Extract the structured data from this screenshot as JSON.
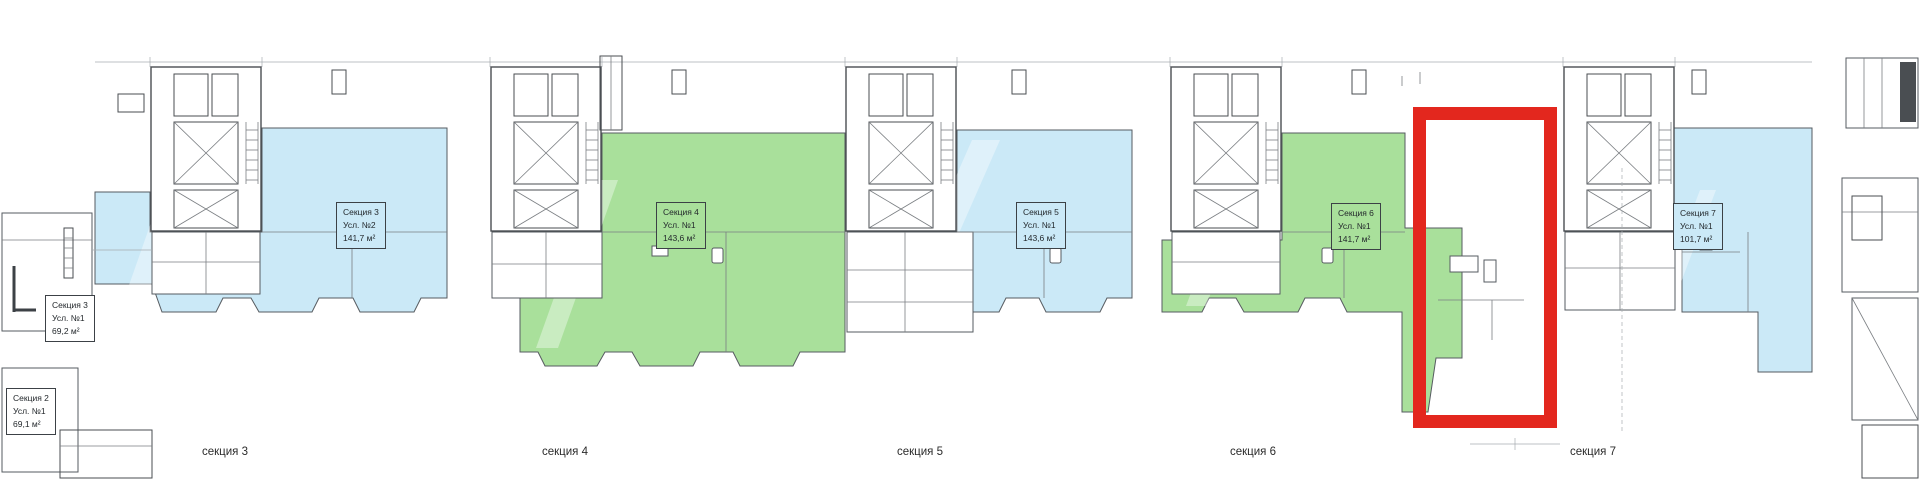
{
  "units": [
    {
      "section": "Секция 3",
      "unit": "Усл. №2",
      "area": "141,7 м²",
      "fill": "blue"
    },
    {
      "section": "Секция 3",
      "unit": "Усл. №1",
      "area": "69,2 м²",
      "fill": "white"
    },
    {
      "section": "Секция 2",
      "unit": "Усл. №1",
      "area": "69,1 м²",
      "fill": "white"
    },
    {
      "section": "Секция 4",
      "unit": "Усл. №1",
      "area": "143,6 м²",
      "fill": "green"
    },
    {
      "section": "Секция 5",
      "unit": "Усл. №1",
      "area": "143,6 м²",
      "fill": "blue"
    },
    {
      "section": "Секция 6",
      "unit": "Усл. №1",
      "area": "141,7 м²",
      "fill": "green"
    },
    {
      "section": "Секция 7",
      "unit": "Усл. №1",
      "area": "101,7 м²",
      "fill": "blue"
    }
  ],
  "axis": [
    "секция 3",
    "секция 4",
    "секция 5",
    "секция 6",
    "секция 7"
  ],
  "colors": {
    "blue": "#cbe9f7",
    "green": "#a9e09b",
    "red": "#e3271e"
  }
}
